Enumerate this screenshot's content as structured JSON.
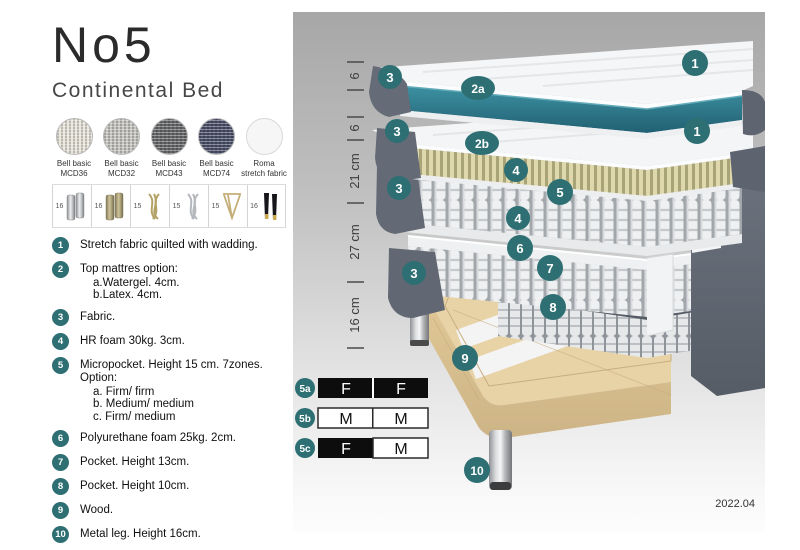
{
  "header": {
    "title": "No5",
    "subtitle": "Continental Bed"
  },
  "fabrics": {
    "items": [
      {
        "line1": "Bell basic",
        "line2": "MCD36",
        "color": "#e9e5da"
      },
      {
        "line1": "Bell basic",
        "line2": "MCD32",
        "color": "#c6c5c1"
      },
      {
        "line1": "Bell basic",
        "line2": "MCD43",
        "color": "#66686a"
      },
      {
        "line1": "Bell basic",
        "line2": "MCD74",
        "color": "#4b5069"
      },
      {
        "line1": "Roma",
        "line2": "stretch fabric",
        "color": "#f6f6f6"
      }
    ]
  },
  "legs": {
    "items": [
      {
        "size": "16",
        "type": "chrome-cylinder-legs"
      },
      {
        "size": "16",
        "type": "brass-cylinder-legs"
      },
      {
        "size": "15",
        "type": "gold-twisted-legs"
      },
      {
        "size": "15",
        "type": "silver-twisted-legs"
      },
      {
        "size": "15",
        "type": "gold-hairpin-leg"
      },
      {
        "size": "16",
        "type": "black-legs-brass-tip"
      }
    ]
  },
  "spec_list": {
    "items": [
      {
        "num": "1",
        "text": "Stretch fabric quilted with wadding.",
        "subs": []
      },
      {
        "num": "2",
        "text": "Top mattres option:",
        "subs": [
          "a.Watergel. 4cm.",
          "b.Latex. 4cm."
        ]
      },
      {
        "num": "3",
        "text": "Fabric.",
        "subs": []
      },
      {
        "num": "4",
        "text": "HR foam 30kg. 3cm.",
        "subs": []
      },
      {
        "num": "5",
        "text": "Micropocket. Height 15 cm. 7zones. Option:",
        "subs": [
          "a. Firm/ firm",
          "b. Medium/ medium",
          "c. Firm/ medium"
        ]
      },
      {
        "num": "6",
        "text": "Polyurethane foam 25kg. 2cm.",
        "subs": []
      },
      {
        "num": "7",
        "text": "Pocket. Height 13cm.",
        "subs": []
      },
      {
        "num": "8",
        "text": "Pocket. Height 10cm.",
        "subs": []
      },
      {
        "num": "9",
        "text": "Wood.",
        "subs": []
      },
      {
        "num": "10",
        "text": "Metal leg. Height 16cm.",
        "subs": []
      }
    ]
  },
  "diagram": {
    "ruler": [
      {
        "label": "6"
      },
      {
        "label": "6"
      },
      {
        "label": "21 cm"
      },
      {
        "label": "27 cm"
      },
      {
        "label": "16 cm"
      }
    ],
    "badges": {
      "b1": "1",
      "b2a": "2a",
      "b2b": "2b",
      "b3": "3",
      "b4": "4",
      "b5": "5",
      "b6": "6",
      "b7": "7",
      "b8": "8",
      "b9": "9",
      "b10": "10"
    },
    "firmness": {
      "rows": [
        {
          "id": "5a",
          "cells": [
            {
              "label": "F",
              "variant": "dark"
            },
            {
              "label": "F",
              "variant": "dark"
            }
          ]
        },
        {
          "id": "5b",
          "cells": [
            {
              "label": "M",
              "variant": "light"
            },
            {
              "label": "M",
              "variant": "light"
            }
          ]
        },
        {
          "id": "5c",
          "cells": [
            {
              "label": "F",
              "variant": "dark"
            },
            {
              "label": "M",
              "variant": "light"
            }
          ]
        }
      ]
    },
    "date": "2022.04",
    "colors": {
      "badge": "#2d6f73",
      "watergel": "#2f7e90",
      "latex": "#d9d3a6",
      "fabric_dark": "#5f6570",
      "wood": "#e3cda1"
    }
  }
}
